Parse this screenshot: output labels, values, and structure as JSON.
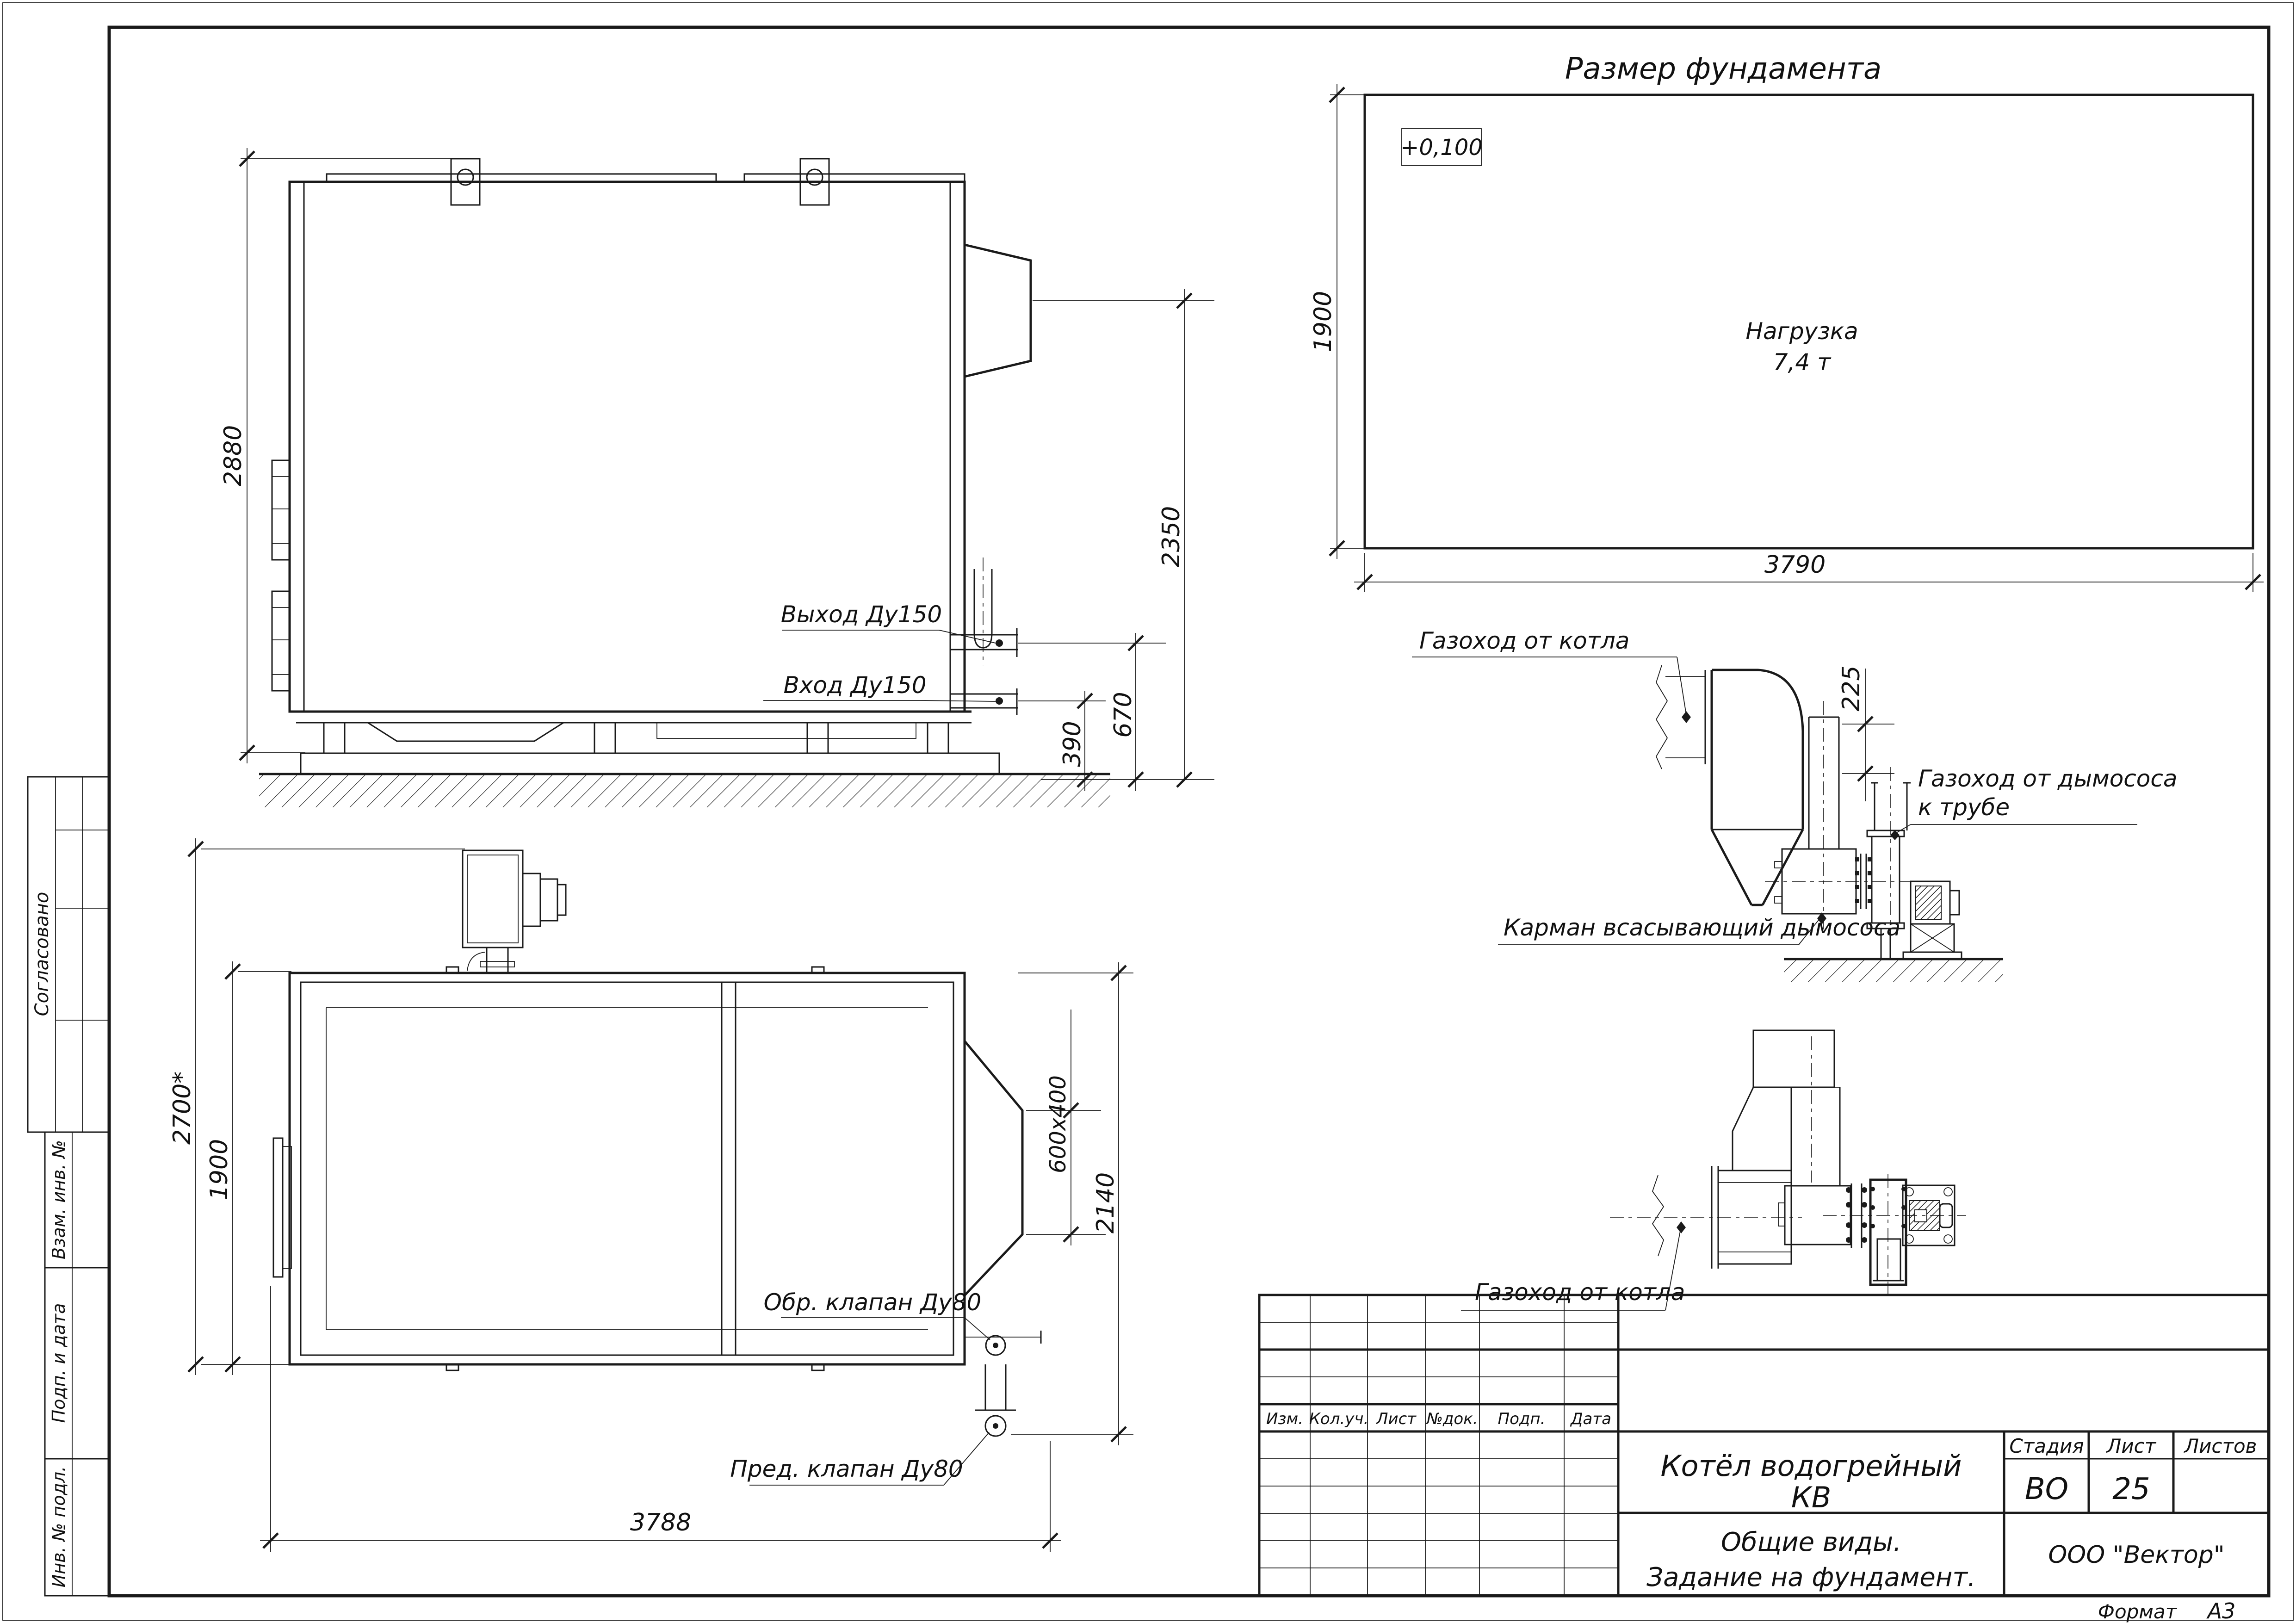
{
  "page": {
    "format_label": "Формат",
    "format_value": "А3"
  },
  "stamps": {
    "approved": "Согласовано",
    "replace_inv": "Взам. инв. №",
    "sign_date": "Подп. и дата",
    "inv_orig": "Инв. № подл."
  },
  "title_block": {
    "rev_headers": [
      "Изм.",
      "Кол.уч.",
      "Лист",
      "№док.",
      "Подп.",
      "Дата"
    ],
    "product_name_line1": "Котёл водогрейный",
    "product_name_line2": "КВ",
    "sheet_title_line1": "Общие виды.",
    "sheet_title_line2": "Задание на фундамент.",
    "stage_label": "Стадия",
    "stage_value": "ВО",
    "sheet_label": "Лист",
    "sheet_value": "25",
    "sheets_label": "Листов",
    "company": "ООО \"Вектор\""
  },
  "foundation": {
    "title": "Размер фундамента",
    "elevation_mark": "+0,100",
    "load_line1": "Нагрузка",
    "load_line2": "7,4 т",
    "depth": "1900",
    "width": "3790"
  },
  "side_view": {
    "dim_height": "2880",
    "dim_chimney": "2350",
    "dim_outlet": "670",
    "dim_inlet": "390",
    "label_outlet": "Выход Ду150",
    "label_inlet": "Вход Ду150"
  },
  "plan_view": {
    "dim_width_total": "2700*",
    "dim_width": "1900",
    "dim_flue": "600х400",
    "dim_right": "2140",
    "dim_length": "3788",
    "label_check_valve": "Обр. клапан Ду80",
    "label_safety_valve": "Пред. клапан Ду80"
  },
  "gas_ducts": {
    "label_from_boiler_1": "Газоход от котла",
    "label_from_boiler_2": "Газоход от котла",
    "label_to_chimney_line1": "Газоход от дымососа",
    "label_to_chimney_line2": "к трубе",
    "label_pocket": "Карман всасывающий дымососа",
    "dim_offset": "225"
  }
}
